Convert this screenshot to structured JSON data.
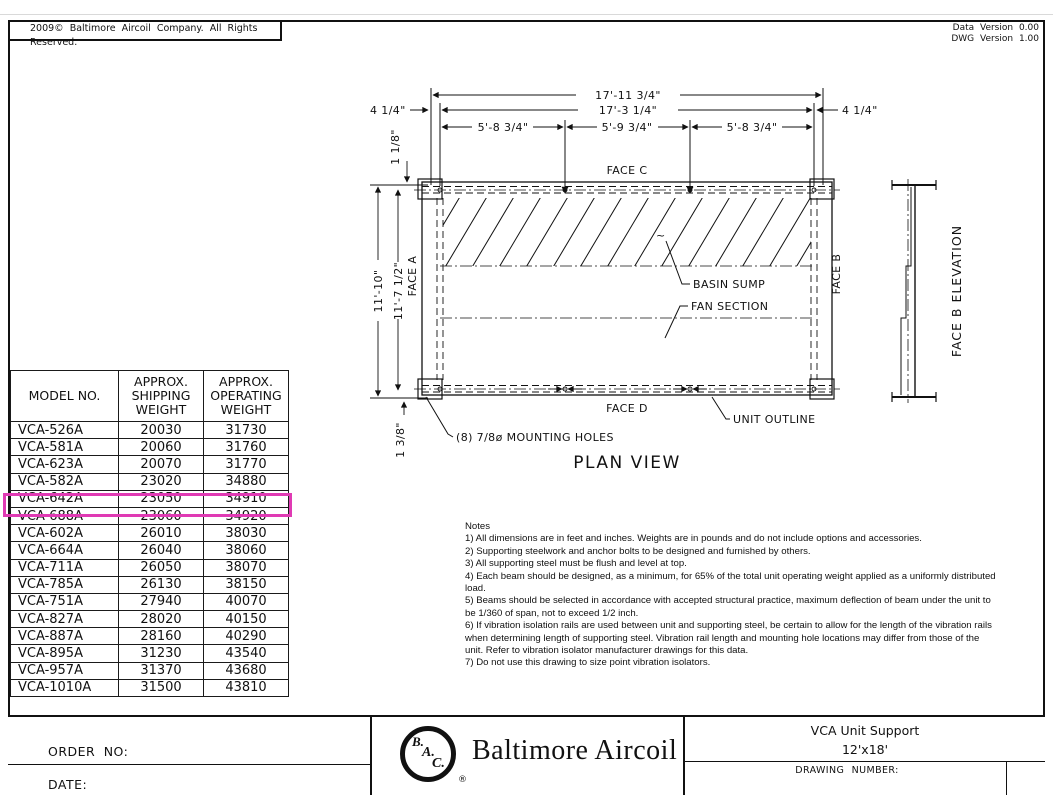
{
  "page": {
    "copyright": "2009© Baltimore Aircoil Company. All Rights Reserved.",
    "data_version": "Data Version 0.00",
    "dwg_version": "DWG Version 1.00"
  },
  "weight_table": {
    "headers": [
      "MODEL NO.",
      "APPROX.\nSHIPPING\nWEIGHT",
      "APPROX.\nOPERATING\nWEIGHT"
    ],
    "rows": [
      {
        "model": "VCA-526A",
        "shipping": "20030",
        "operating": "31730"
      },
      {
        "model": "VCA-581A",
        "shipping": "20060",
        "operating": "31760"
      },
      {
        "model": "VCA-623A",
        "shipping": "20070",
        "operating": "31770"
      },
      {
        "model": "VCA-582A",
        "shipping": "23020",
        "operating": "34880"
      },
      {
        "model": "VCA-642A",
        "shipping": "23050",
        "operating": "34910"
      },
      {
        "model": "VCA-688A",
        "shipping": "23060",
        "operating": "34920"
      },
      {
        "model": "VCA-602A",
        "shipping": "26010",
        "operating": "38030"
      },
      {
        "model": "VCA-664A",
        "shipping": "26040",
        "operating": "38060"
      },
      {
        "model": "VCA-711A",
        "shipping": "26050",
        "operating": "38070"
      },
      {
        "model": "VCA-785A",
        "shipping": "26130",
        "operating": "38150"
      },
      {
        "model": "VCA-751A",
        "shipping": "27940",
        "operating": "40070"
      },
      {
        "model": "VCA-827A",
        "shipping": "28020",
        "operating": "40150"
      },
      {
        "model": "VCA-887A",
        "shipping": "28160",
        "operating": "40290"
      },
      {
        "model": "VCA-895A",
        "shipping": "31230",
        "operating": "43540"
      },
      {
        "model": "VCA-957A",
        "shipping": "31370",
        "operating": "43680"
      },
      {
        "model": "VCA-1010A",
        "shipping": "31500",
        "operating": "43810"
      }
    ],
    "highlighted_model": "VCA-642A",
    "highlight_color": "#e03ab4"
  },
  "plan_view": {
    "title": "PLAN VIEW",
    "dims": {
      "overall_width": "17'-11 3/4\"",
      "bolt_width": "17'-3 1/4\"",
      "span_left": "5'-8 3/4\"",
      "span_mid": "5'-9 3/4\"",
      "span_right": "5'-8 3/4\"",
      "offset_left": "4 1/4\"",
      "offset_right": "4 1/4\"",
      "edge_top": "1 1/8\"",
      "overall_depth": "11'-10\"",
      "bolt_depth": "11'-7 1/2\"",
      "edge_bottom": "1 3/8\""
    },
    "labels": {
      "face_a": "FACE A",
      "face_b": "FACE B",
      "face_c": "FACE C",
      "face_d": "FACE D",
      "basin_sump": "BASIN SUMP",
      "fan_section": "FAN SECTION",
      "unit_outline": "UNIT OUTLINE",
      "mounting_holes": "(8) 7/8ø MOUNTING HOLES",
      "squiggle": "~"
    },
    "elevation_title": "FACE B ELEVATION"
  },
  "notes": {
    "title": "Notes",
    "items": [
      "1) All dimensions are in feet and inches. Weights are in pounds and do not include options and accessories.",
      "2) Supporting steelwork and anchor bolts to be designed and furnished by others.",
      "3) All supporting steel must be flush and level at top.",
      "4) Each beam should be designed, as a minimum, for 65% of the total unit operating weight applied as a uniformly distributed load.",
      "5) Beams should be selected in accordance with accepted structural practice, maximum deflection of beam under the unit to be 1/360 of span, not to exceed 1/2 inch.",
      "6) If vibration isolation rails are used between unit and supporting steel, be certain to allow for the length of the vibration rails when determining length of supporting steel. Vibration rail length and mounting hole locations may differ from those of the unit. Refer to vibration isolator manufacturer drawings for this data.",
      "7) Do not use this drawing to size point vibration isolators."
    ]
  },
  "title_block": {
    "order_label": "ORDER NO:",
    "date_label": "DATE:",
    "logo_letters": [
      "B.",
      "A.",
      "C."
    ],
    "registered": "®",
    "company": "Baltimore Aircoil",
    "product_title": "VCA Unit Support",
    "product_size": "12'x18'",
    "drawing_number_label": "DRAWING NUMBER:"
  }
}
